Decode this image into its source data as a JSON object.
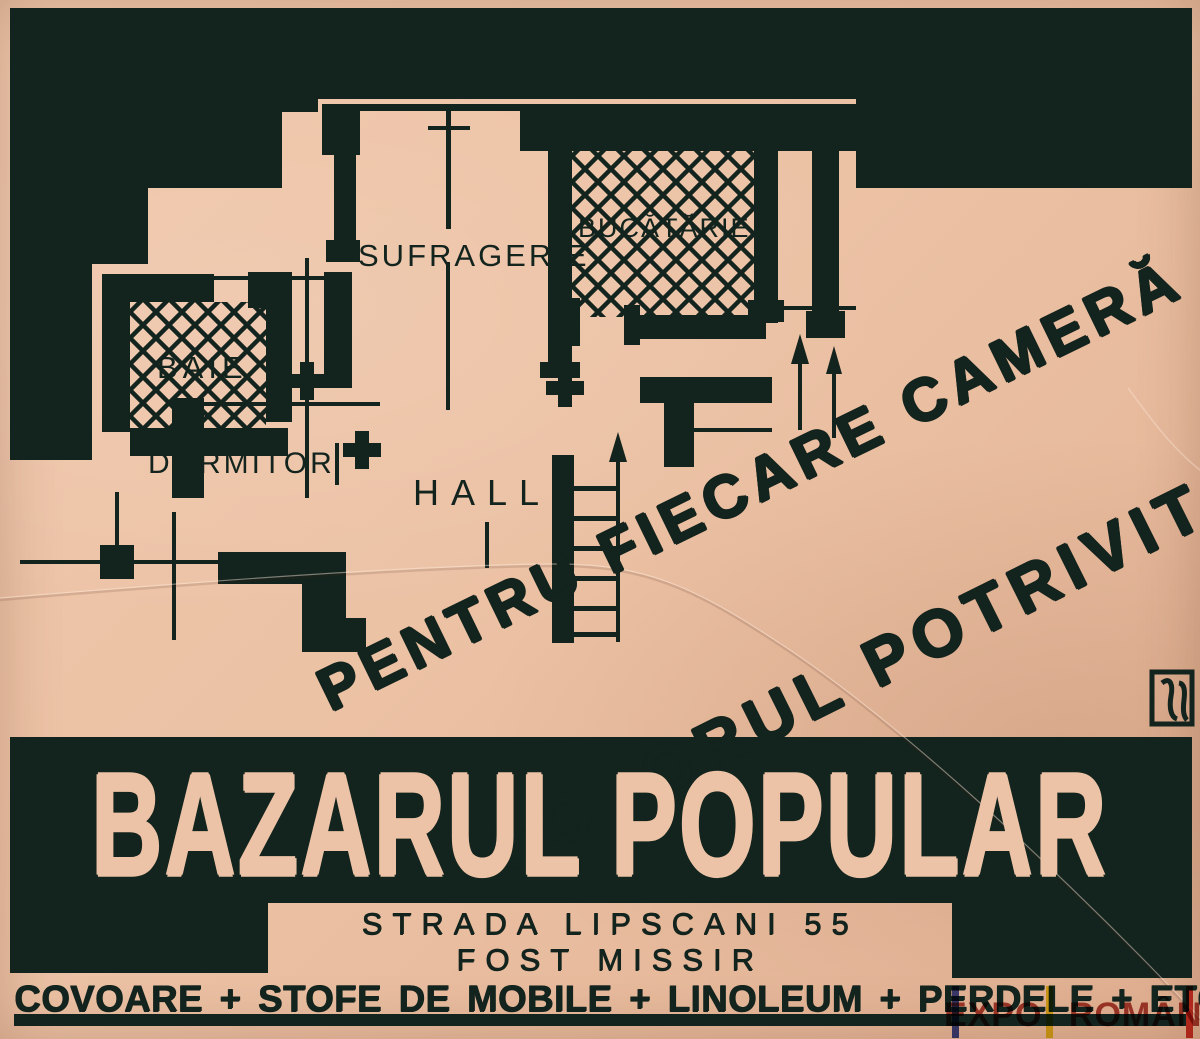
{
  "colors": {
    "paper": "#ecc3a6",
    "ink": "#13231d",
    "watermark_red": "#9c2318",
    "flag_blue": "#2d3cae",
    "flag_yellow": "#e3d50e",
    "flag_red": "#d22a1e"
  },
  "slogan": {
    "line1": "PENTRU FIECARE CAMERĂ",
    "line2": "COVORUL POTRIVIT"
  },
  "floor_plan": {
    "rooms": [
      {
        "id": "sufragerie",
        "label": "SUFRAGERIE",
        "hatched": false
      },
      {
        "id": "bucatarie",
        "label": "BUCĂTĂRIE",
        "hatched": true
      },
      {
        "id": "baie",
        "label": "BAIE",
        "hatched": true
      },
      {
        "id": "dormitor",
        "label": "DORMITOR",
        "hatched": false
      },
      {
        "id": "hall",
        "label": "HALL",
        "hatched": false
      }
    ]
  },
  "store": {
    "name": "BAZARUL POPULAR",
    "address_line1": "STRADA LIPSCANI 55",
    "address_line2": "FOST MISSIR",
    "products_line": "COVOARE + STOFE DE MOBILE + LINOLEUM + PERDELE + ETC"
  },
  "watermark": {
    "text": "EXPO ROMÂNIA"
  }
}
